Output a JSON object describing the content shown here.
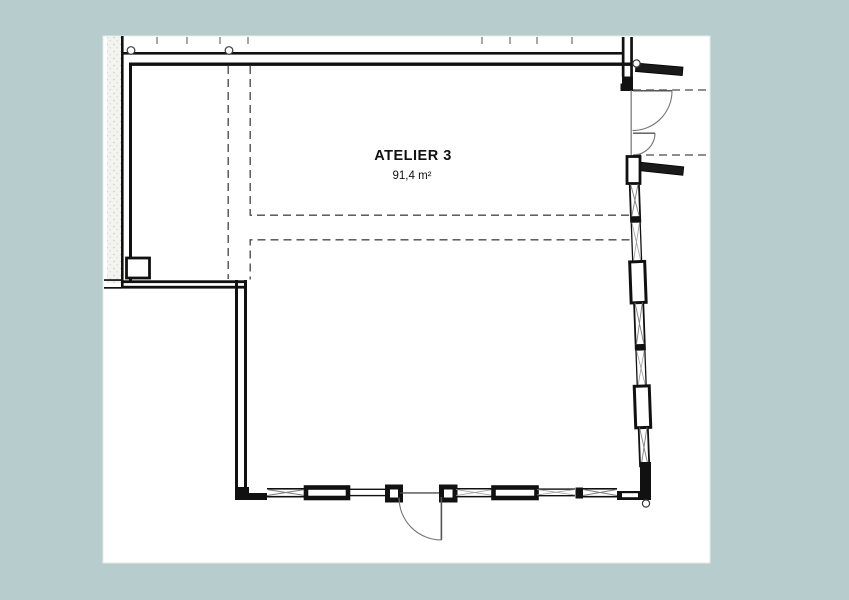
{
  "colors": {
    "canvas_bg": "#b6cccd",
    "sheet_bg": "#ffffff",
    "wall_line": "#111111",
    "dashed_line": "#4a4a4a",
    "swing_line": "#777777",
    "hatch_line": "#7d7d7d",
    "tick_mark": "#a8a8a8"
  },
  "plan": {
    "room": {
      "name": "ATELIER 3",
      "area": "91,4 m²"
    }
  }
}
